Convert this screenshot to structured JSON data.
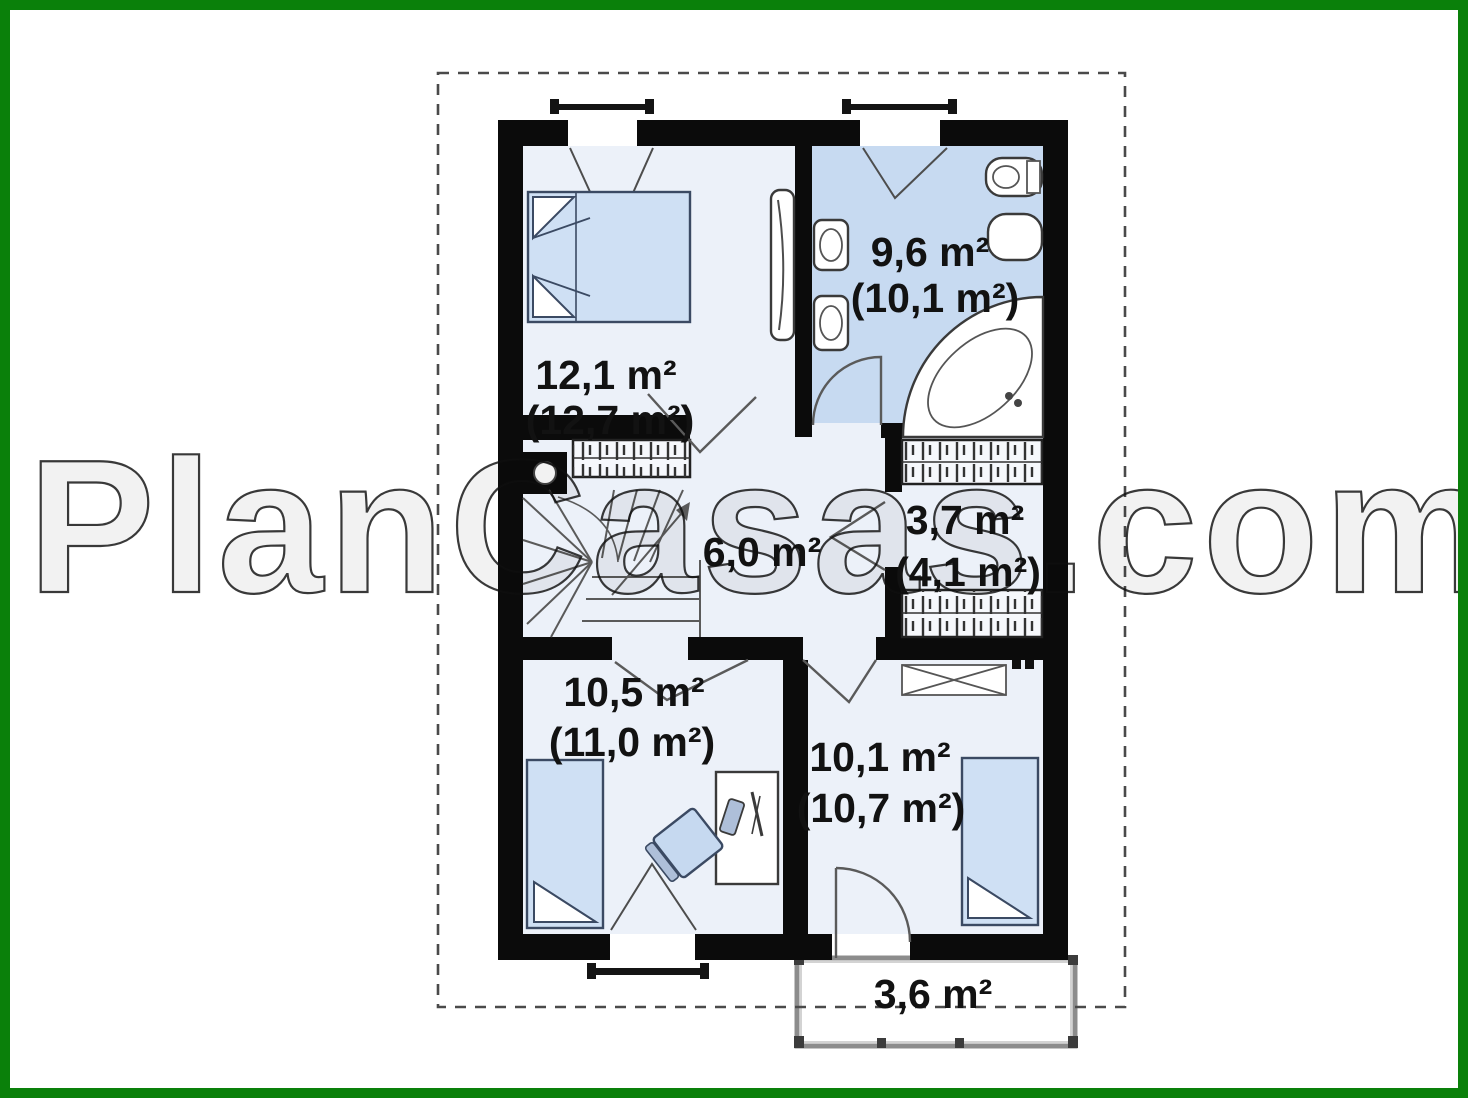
{
  "watermark": "PlanCasas.com",
  "colors": {
    "frame_green": "#0a800a",
    "wall_black": "#0b0b0b",
    "bathroom_floor": "#c7daf1",
    "room_floor": "#ecf1f9",
    "furniture_blue": "#cfe0f4",
    "chair_blue": "#c6d9f0",
    "dashed_gray": "#4a4a4a",
    "label_color": "#121212"
  },
  "rooms": [
    {
      "id": "bedroom-top-left",
      "area": "12,1 m²",
      "area_gross": "(12,7 m²)"
    },
    {
      "id": "bathroom",
      "area": "9,6 m²",
      "area_gross": "(10,1 m²)"
    },
    {
      "id": "wardrobe",
      "area": "3,7 m²",
      "area_gross": "(4,1 m²)"
    },
    {
      "id": "hall",
      "area": "6,0 m²"
    },
    {
      "id": "bedroom-bottom-left",
      "area": "10,5 m²",
      "area_gross": "(11,0 m²)"
    },
    {
      "id": "bedroom-bottom-right",
      "area": "10,1 m²",
      "area_gross": "(10,7 m²)"
    },
    {
      "id": "balcony",
      "area": "3,6 m²"
    }
  ]
}
